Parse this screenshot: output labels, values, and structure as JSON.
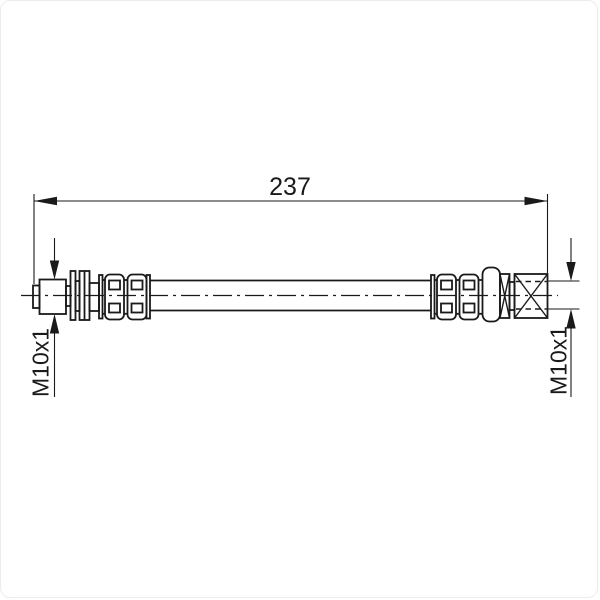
{
  "page": {
    "background": "#ffffff",
    "border_color": "#ececec"
  },
  "drawing": {
    "type": "technical-drawing",
    "subject": "brake-hose-side-view",
    "line_color": "#1a1a1a",
    "labels": {
      "overall_length": "237",
      "left_thread": "M10x1",
      "right_thread": "M10x1"
    }
  }
}
